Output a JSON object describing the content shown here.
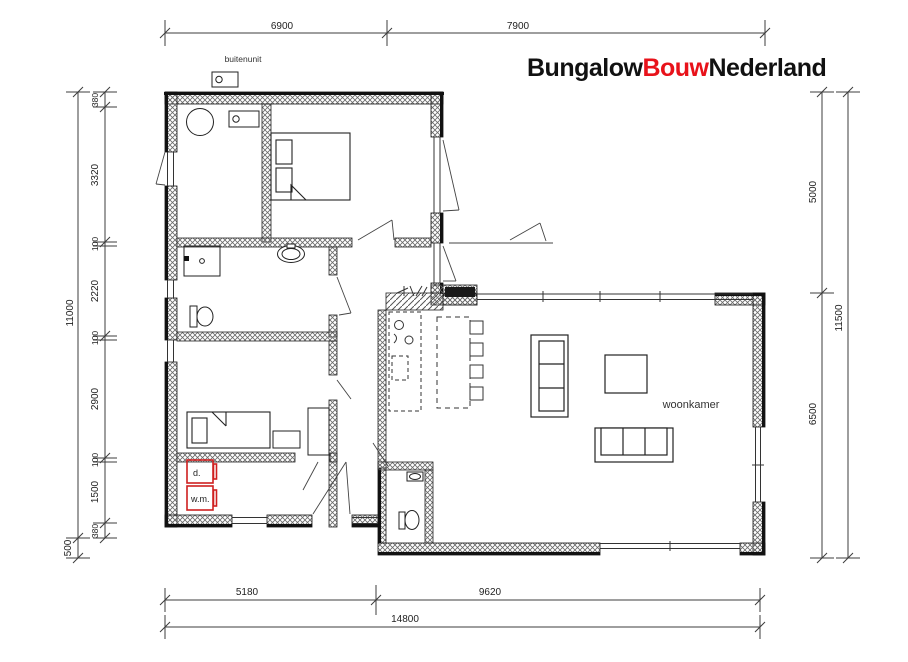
{
  "logo": {
    "bungalow": "Bungalow",
    "bouw": "Bouw",
    "nederland": "Nederland"
  },
  "labels": {
    "buitenunit": "buitenunit",
    "woonkamer": "woonkamer",
    "dryer": "d.",
    "washing_machine": "w.m."
  },
  "dims": {
    "top": {
      "left": "6900",
      "right": "7900"
    },
    "left": {
      "overall": "11000",
      "segments": [
        "380",
        "3320",
        "100",
        "2220",
        "100",
        "2900",
        "100",
        "1500",
        "380"
      ],
      "offset": "500"
    },
    "right": {
      "top": "5000",
      "bottom": "6500",
      "overall": "11500"
    },
    "bottom": {
      "left": "5180",
      "right": "9620",
      "overall": "14800"
    }
  },
  "colors": {
    "wall": "#111111",
    "accent_red": "#cf1f1f",
    "logo_red": "#e8121a",
    "dim_line": "#3c3c3c"
  }
}
